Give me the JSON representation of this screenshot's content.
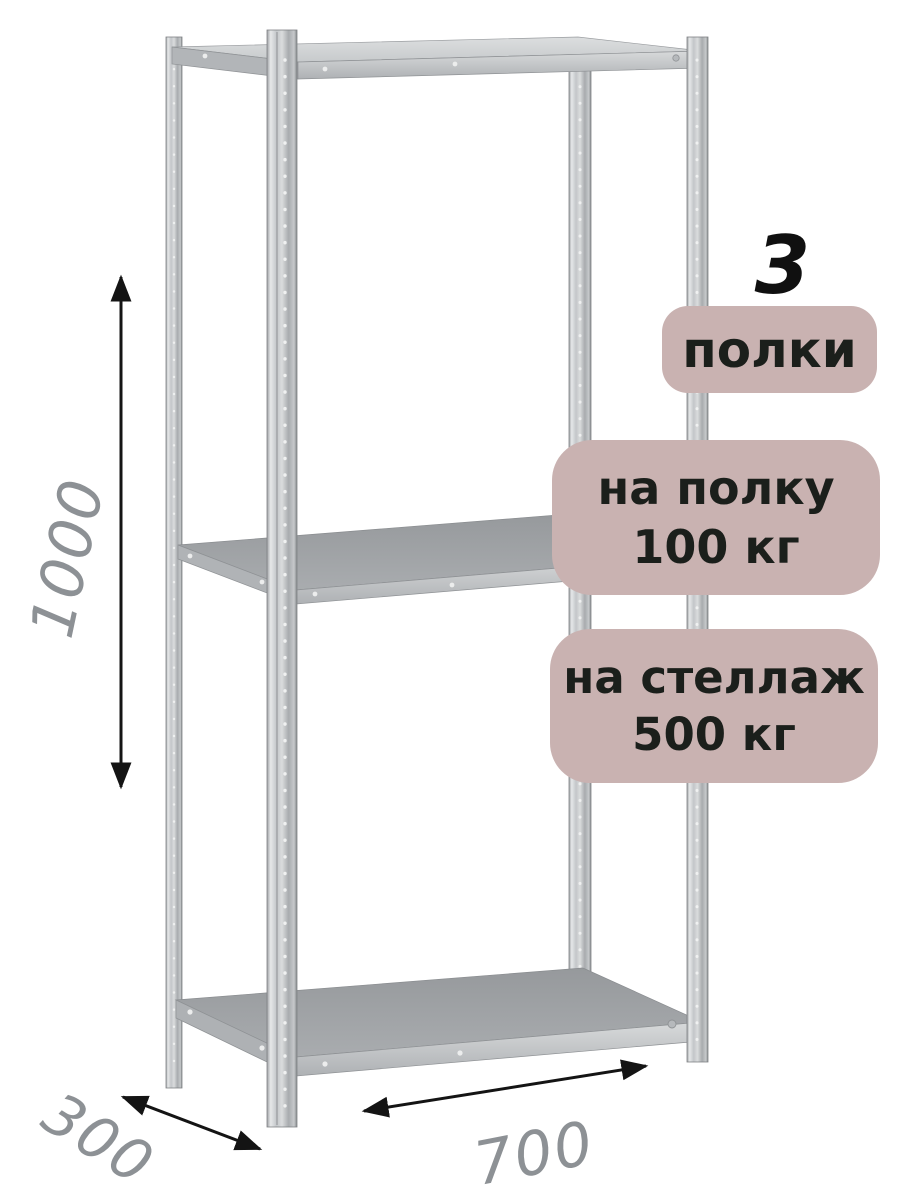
{
  "badges": {
    "shelf_count_number": "3",
    "shelf_count_label": "полки",
    "shelf_load_line1": "на полку",
    "shelf_load_line2": "100 кг",
    "rack_load_line1": "на стеллаж",
    "rack_load_line2": "500 кг"
  },
  "dimensions": {
    "height_mm": "1000",
    "depth_mm": "300",
    "width_mm": "700"
  },
  "illustration": {
    "subject": "metal-boltless-shelving-rack",
    "shelves_visible": 3,
    "posts_visible": 4
  },
  "colors": {
    "background": "#ffffff",
    "badge_background": "#c9b2b1",
    "badge_text": "#1b1f1b",
    "dimension_text": "#8d9195",
    "arrow": "#141414",
    "metal_light": "#e3e5e6",
    "metal_mid": "#b9bcbf",
    "metal_dark": "#84878a"
  }
}
